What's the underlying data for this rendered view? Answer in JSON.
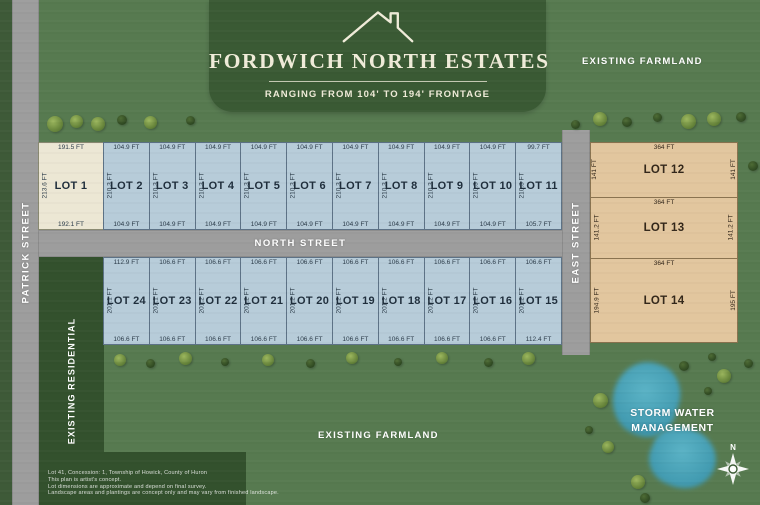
{
  "title": {
    "name": "FORDWICH NORTH ESTATES",
    "subtitle": "RANGING FROM 104' TO 194' FRONTAGE"
  },
  "labels": {
    "existing_farmland_top": "EXISTING FARMLAND",
    "existing_farmland_bottom": "EXISTING FARMLAND",
    "existing_residential": "EXISTING RESIDENTIAL",
    "patrick_street": "PATRICK STREET",
    "north_street": "NORTH STREET",
    "east_street": "EAST STREET",
    "storm_line1": "STORM WATER",
    "storm_line2": "MANAGEMENT",
    "compass_north": "N"
  },
  "disclaimer": [
    "Lot 41, Concession: 1, Township of Howick, County of Huron",
    "This plan is artist's concept.",
    "Lot dimensions are approximate and depend on final survey.",
    "Landscape areas and plantings are concept only and may vary from finished landscape."
  ],
  "lots": {
    "top_row": [
      {
        "id": 1,
        "name": "LOT 1",
        "top": "191.5 FT",
        "side": "213.6 FT",
        "bottom": "192.1 FT",
        "fill": "cream"
      },
      {
        "id": 2,
        "name": "LOT 2",
        "top": "104.9 FT",
        "side": "210.3 FT",
        "bottom": "104.9 FT",
        "fill": "blue"
      },
      {
        "id": 3,
        "name": "LOT 3",
        "top": "104.9 FT",
        "side": "210.3 FT",
        "bottom": "104.9 FT",
        "fill": "blue"
      },
      {
        "id": 4,
        "name": "LOT 4",
        "top": "104.9 FT",
        "side": "210.3 FT",
        "bottom": "104.9 FT",
        "fill": "blue"
      },
      {
        "id": 5,
        "name": "LOT 5",
        "top": "104.9 FT",
        "side": "210.3 FT",
        "bottom": "104.9 FT",
        "fill": "blue"
      },
      {
        "id": 6,
        "name": "LOT 6",
        "top": "104.9 FT",
        "side": "210.3 FT",
        "bottom": "104.9 FT",
        "fill": "blue"
      },
      {
        "id": 7,
        "name": "LOT 7",
        "top": "104.9 FT",
        "side": "210.3 FT",
        "bottom": "104.9 FT",
        "fill": "blue"
      },
      {
        "id": 8,
        "name": "LOT 8",
        "top": "104.9 FT",
        "side": "210.3 FT",
        "bottom": "104.9 FT",
        "fill": "blue"
      },
      {
        "id": 9,
        "name": "LOT 9",
        "top": "104.9 FT",
        "side": "210.3 FT",
        "bottom": "104.9 FT",
        "fill": "blue"
      },
      {
        "id": 10,
        "name": "LOT 10",
        "top": "104.9 FT",
        "side": "210.3 FT",
        "bottom": "104.9 FT",
        "fill": "blue"
      },
      {
        "id": 11,
        "name": "LOT 11",
        "top": "99.7 FT",
        "side": "210.3 FT",
        "bottom": "105.7 FT",
        "fill": "blue"
      }
    ],
    "bottom_row": [
      {
        "id": 24,
        "name": "LOT 24",
        "top": "112.9 FT",
        "side": "201.1 FT",
        "bottom": "106.6 FT",
        "fill": "blue"
      },
      {
        "id": 23,
        "name": "LOT 23",
        "top": "106.6 FT",
        "side": "201.1 FT",
        "bottom": "106.6 FT",
        "fill": "blue"
      },
      {
        "id": 22,
        "name": "LOT 22",
        "top": "106.6 FT",
        "side": "201.2 FT",
        "bottom": "106.6 FT",
        "fill": "blue"
      },
      {
        "id": 21,
        "name": "LOT 21",
        "top": "106.6 FT",
        "side": "201.2 FT",
        "bottom": "106.6 FT",
        "fill": "blue"
      },
      {
        "id": 20,
        "name": "LOT 20",
        "top": "106.6 FT",
        "side": "201.2 FT",
        "bottom": "106.6 FT",
        "fill": "blue"
      },
      {
        "id": 19,
        "name": "LOT 19",
        "top": "106.6 FT",
        "side": "201.2 FT",
        "bottom": "106.6 FT",
        "fill": "blue"
      },
      {
        "id": 18,
        "name": "LOT 18",
        "top": "106.6 FT",
        "side": "201.2 FT",
        "bottom": "106.6 FT",
        "fill": "blue"
      },
      {
        "id": 17,
        "name": "LOT 17",
        "top": "106.6 FT",
        "side": "201.2 FT",
        "bottom": "106.6 FT",
        "fill": "blue"
      },
      {
        "id": 16,
        "name": "LOT 16",
        "top": "106.6 FT",
        "side": "201.2 FT",
        "bottom": "106.6 FT",
        "fill": "blue"
      },
      {
        "id": 15,
        "name": "LOT 15",
        "top": "106.6 FT",
        "side": "201.2 FT",
        "bottom": "112.4 FT",
        "fill": "blue"
      }
    ],
    "east_column": [
      {
        "id": 12,
        "name": "LOT 12",
        "top": "364 FT",
        "left": "141 FT",
        "right": "141 FT"
      },
      {
        "id": 13,
        "name": "LOT 13",
        "top": "364 FT",
        "left": "141.2 FT",
        "right": "141.2 FT"
      },
      {
        "id": 14,
        "name": "LOT 14",
        "top": "364 FT",
        "left": "194.9 FT",
        "right": "195 FT"
      }
    ]
  },
  "trees": [
    [
      55,
      124,
      16,
      "l"
    ],
    [
      76,
      121,
      13,
      "l"
    ],
    [
      98,
      124,
      14,
      "l"
    ],
    [
      122,
      120,
      10,
      "d"
    ],
    [
      150,
      122,
      13,
      "l"
    ],
    [
      190,
      120,
      9,
      "d"
    ],
    [
      575,
      124,
      9,
      "d"
    ],
    [
      600,
      119,
      14,
      "l"
    ],
    [
      627,
      122,
      10,
      "d"
    ],
    [
      657,
      117,
      9,
      "d"
    ],
    [
      688,
      121,
      15,
      "l"
    ],
    [
      714,
      119,
      14,
      "l"
    ],
    [
      741,
      117,
      10,
      "d"
    ],
    [
      753,
      166,
      10,
      "d"
    ],
    [
      120,
      360,
      12,
      "l"
    ],
    [
      150,
      363,
      9,
      "d"
    ],
    [
      185,
      358,
      13,
      "l"
    ],
    [
      225,
      362,
      8,
      "d"
    ],
    [
      268,
      360,
      12,
      "l"
    ],
    [
      310,
      363,
      9,
      "d"
    ],
    [
      352,
      358,
      12,
      "l"
    ],
    [
      398,
      362,
      8,
      "d"
    ],
    [
      442,
      358,
      12,
      "l"
    ],
    [
      488,
      362,
      9,
      "d"
    ],
    [
      528,
      358,
      13,
      "l"
    ],
    [
      600,
      400,
      15,
      "l"
    ],
    [
      608,
      447,
      12,
      "l"
    ],
    [
      638,
      482,
      14,
      "l"
    ],
    [
      684,
      366,
      10,
      "d"
    ],
    [
      712,
      357,
      8,
      "d"
    ],
    [
      724,
      376,
      14,
      "l"
    ],
    [
      708,
      391,
      8,
      "d"
    ],
    [
      748,
      363,
      9,
      "d"
    ],
    [
      645,
      498,
      10,
      "d"
    ],
    [
      589,
      430,
      8,
      "d"
    ]
  ],
  "colors": {
    "bg": "#577a50",
    "bg_dark": "#33512d",
    "edge_strip": "#3e5a38",
    "banner": "#3a5a34",
    "road": "#9d9d9d",
    "road_edge": "#8b8b8b",
    "lot_blue": "#b7ccd9",
    "lot_blue_border": "#5d7286",
    "lot_cream": "#ece7d4",
    "lot_cream_border": "#8a8a72",
    "lot_tan": "#e2c69e",
    "lot_tan_border": "#8a7350",
    "lot_text": "#1f2e3c",
    "dim_text": "#2c3c4a",
    "tan_text": "#33271a",
    "pond_hi": "#5bb3c6",
    "pond_lo": "#3e97ad",
    "cream": "#f0ecd9",
    "tree_light_hi": "#9cb75e",
    "tree_light_lo": "#55742f",
    "tree_dark_hi": "#4e6c35",
    "tree_dark_lo": "#27401d"
  }
}
